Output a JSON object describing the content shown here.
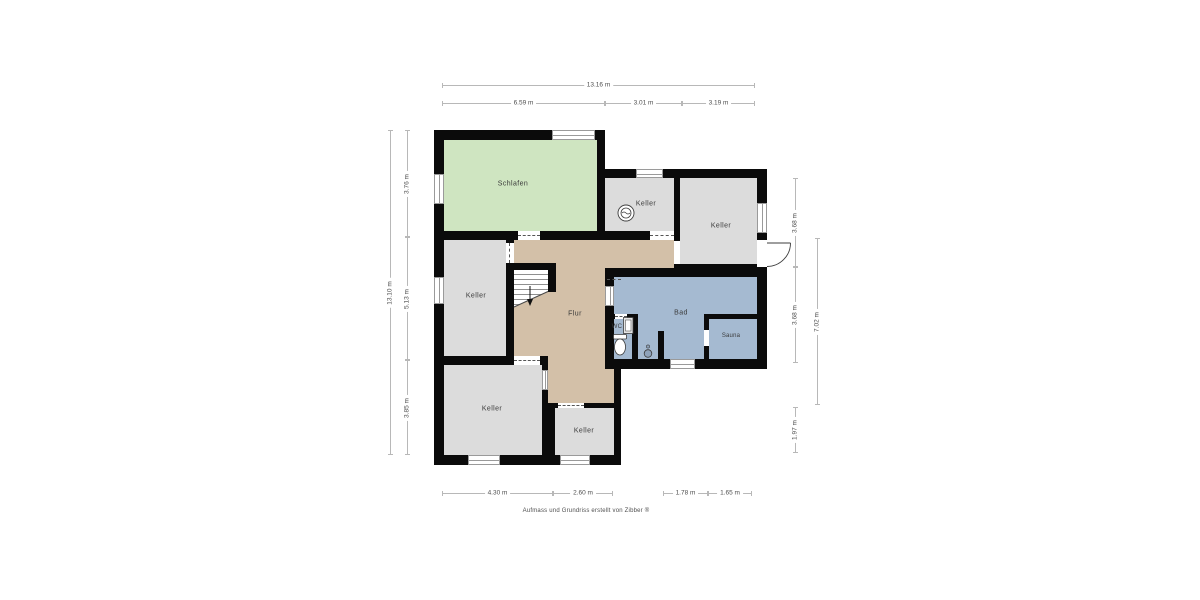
{
  "rooms": {
    "schlafen": "Schlafen",
    "keller_top": "Keller",
    "keller_right": "Keller",
    "keller_mid": "Keller",
    "keller_bottom_left": "Keller",
    "keller_bottom_center": "Keller",
    "flur": "Flur",
    "bad": "Bad",
    "wc": "WC",
    "sauna": "Sauna"
  },
  "dimensions": {
    "top_total": "13.16 m",
    "top_1": "6.59 m",
    "top_2": "3.01 m",
    "top_3": "3.19 m",
    "left_total": "13.10 m",
    "left_1": "3.76 m",
    "left_2": "5.13 m",
    "left_3": "3.85 m",
    "right_1": "3.68 m",
    "right_2": "3.68 m",
    "right_3": "1.97 m",
    "right_total": "7.02 m",
    "bottom_1": "4.30 m",
    "bottom_2": "2.60 m",
    "bottom_3": "1.78 m",
    "bottom_4": "1.65 m"
  },
  "footer": "Aufmass und Grundriss erstellt von Zibber ®",
  "colors": {
    "wall": "#0b0b0b",
    "schlafen": "#cfe5c1",
    "keller": "#dcdcdc",
    "flur": "#d3c0a8",
    "bad": "#a5bad1",
    "dimension_line": "#b8b8b8"
  },
  "icons": {
    "washing_machine": "washing-machine-icon",
    "toilet": "toilet-icon",
    "sink": "sink-icon",
    "shower": "shower-drain-icon",
    "stairs_arrow": "stairs-down-arrow-icon",
    "door_arc": "door-swing-icon"
  }
}
